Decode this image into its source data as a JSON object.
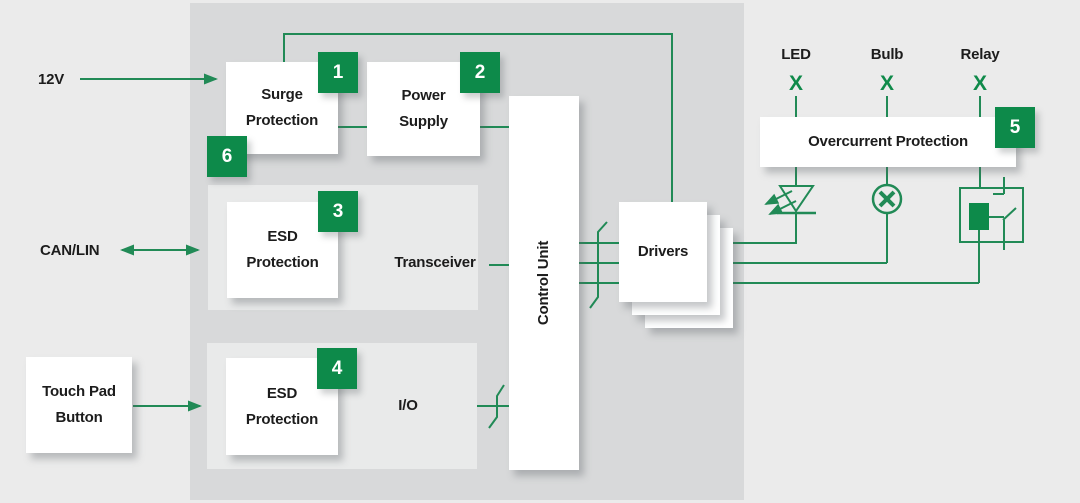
{
  "colors": {
    "accent_green": "#0d8a4a",
    "line_green": "#218a56",
    "panel_gray": "#d8d9da",
    "background_gray": "#ebebeb",
    "container_gray": "#e9eaea",
    "text_dark": "#1c1c1c"
  },
  "inputs": {
    "supply_12v": {
      "label": "12V"
    },
    "can_lin": {
      "label": "CAN/LIN"
    },
    "touch_pad": {
      "label_line1": "Touch Pad",
      "label_line2": "Button"
    }
  },
  "blocks": {
    "surge_protection": {
      "label_line1": "Surge",
      "label_line2": "Protection"
    },
    "power_supply": {
      "label_line1": "Power",
      "label_line2": "Supply"
    },
    "esd_protection_can": {
      "label_line1": "ESD",
      "label_line2": "Protection"
    },
    "transceiver": {
      "label": "Transceiver"
    },
    "esd_protection_io": {
      "label_line1": "ESD",
      "label_line2": "Protection"
    },
    "io": {
      "label": "I/O"
    },
    "control_unit": {
      "label": "Control Unit"
    },
    "drivers": {
      "label": "Drivers"
    },
    "overcurrent_protection": {
      "label": "Overcurrent Protection"
    }
  },
  "badges": {
    "surge": "1",
    "power_supply": "2",
    "esd_can": "3",
    "esd_io": "4",
    "overcurrent": "5",
    "surge_bottom": "6"
  },
  "loads": [
    {
      "name": "LED",
      "mark": "X"
    },
    {
      "name": "Bulb",
      "mark": "X"
    },
    {
      "name": "Relay",
      "mark": "X"
    }
  ]
}
